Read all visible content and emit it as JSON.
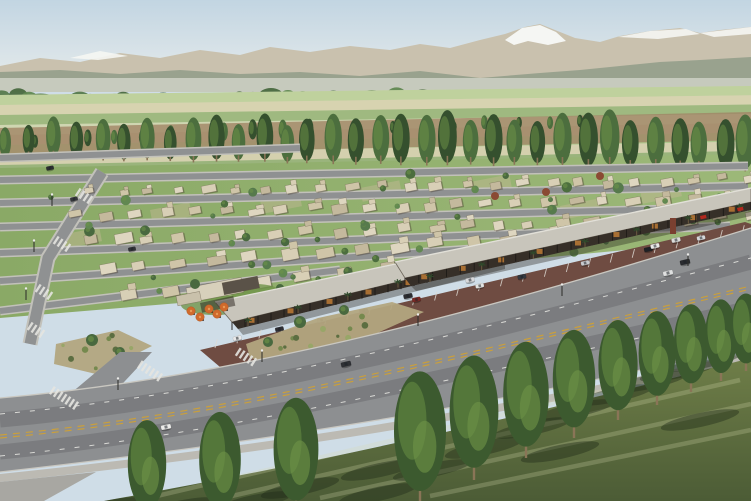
{
  "meta": {
    "title": "Aerial rendering of master-planned community",
    "description": "Aerial 3D architectural rendering of a desert master-planned community: diagonal rows of flat-roofed single-storey homes with lawns and trees, a canopied retail strip with angled parking and orange patio umbrellas, a curved boulevard lined with tall poplars in the foreground, and farmland with poplar windrows rising to snow-capped mountains under a pale hazy sky.",
    "canvas": {
      "width": 751,
      "height": 501
    }
  },
  "palette": {
    "skyTop": "#c2d5e2",
    "skyHor": "#e9edec",
    "mountain": "#c9c1ae",
    "snow": "#f5f6f3",
    "foothill": "#95a08b",
    "haze": "#d9dcd1",
    "tree1": "#567a4c",
    "tree2": "#49693f",
    "tree3": "#618851",
    "fieldBase": "#ccd4b0",
    "dirt": "#a08465",
    "poplarD": "#35502e",
    "poplarM": "#4c6e3e",
    "poplarL": "#6f9448",
    "lawn": "#8aa966",
    "lawnL": "#9cb878",
    "patch": "#c6b996",
    "street": "#8f9192",
    "sidewalk": "#c2c1ba",
    "houseFills": [
      "#d8cfb6",
      "#cfc5a8",
      "#c4b99d",
      "#ded6c0"
    ],
    "houseEdge": "rgba(90,78,60,0.55)",
    "houseShadow": "rgba(60,50,38,0.35)",
    "roofStrip": "#c8c5bb",
    "roofHi": "#e2e0d8",
    "roofEdge": "#6e675c",
    "storefront": "#362f28",
    "post": "#1d1a17",
    "glow": "#c57f36",
    "canShadow": "rgba(30,24,18,0.35)",
    "parking": "#6f4c42",
    "stripe": "rgba(222,219,212,0.85)",
    "walkway": "#c5c3bc",
    "bed": "#b2a580",
    "shrubs": [
      "#75894e",
      "#5c6e41",
      "#98a668"
    ],
    "road": "#8d8f91",
    "roadDark": "rgba(58,60,62,0.22)",
    "yellow": "#c99f3d",
    "whiteLine": "rgba(228,228,224,0.9)",
    "curb": "#c9c7c0",
    "sdw": "#bcbab3",
    "corner": "#a8a7a2",
    "grass1": "#6f7e48",
    "grass2": "#4c5c36",
    "streak": "rgba(216,221,176,0.25)",
    "shadow": "rgba(32,42,24,0.42)",
    "trunk": "#8a7557",
    "umb": "#d06a2c",
    "umbHi": "#e89a55",
    "umbRim": "#b35a24",
    "palm": "#2f4a2b",
    "palmTrunk": "#6b5a40",
    "red": "#b3281e",
    "monument": "#7a4030",
    "redTree": "#8a4a33",
    "carCols": [
      "#e8e8e8",
      "#2e2e33",
      "#b8bcc0",
      "#50555c",
      "#7a2a26",
      "#e2e3e1",
      "#34383f",
      "#c9cbcf",
      "#1f2124",
      "#d6d7d9"
    ]
  },
  "sky": {
    "h": 92
  },
  "mountains": {
    "silhouette": [
      [
        0,
        66
      ],
      [
        40,
        58
      ],
      [
        80,
        62
      ],
      [
        120,
        53
      ],
      [
        160,
        58
      ],
      [
        200,
        50
      ],
      [
        240,
        55
      ],
      [
        270,
        47
      ],
      [
        310,
        52
      ],
      [
        350,
        46
      ],
      [
        390,
        50
      ],
      [
        420,
        44
      ],
      [
        450,
        48
      ],
      [
        480,
        40
      ],
      [
        505,
        34
      ],
      [
        525,
        27
      ],
      [
        540,
        24
      ],
      [
        555,
        30
      ],
      [
        575,
        38
      ],
      [
        600,
        42
      ],
      [
        620,
        36
      ],
      [
        650,
        31
      ],
      [
        680,
        28
      ],
      [
        700,
        33
      ],
      [
        720,
        30
      ],
      [
        751,
        27
      ],
      [
        751,
        92
      ],
      [
        0,
        92
      ]
    ],
    "snow_main": [
      [
        505,
        40
      ],
      [
        522,
        28
      ],
      [
        540,
        25
      ],
      [
        556,
        32
      ],
      [
        566,
        41
      ],
      [
        548,
        45
      ],
      [
        528,
        41
      ],
      [
        514,
        45
      ]
    ],
    "snow_patches": [
      [
        [
          70,
          58
        ],
        [
          100,
          51
        ],
        [
          128,
          56
        ],
        [
          98,
          60
        ]
      ],
      [
        [
          618,
          37
        ],
        [
          650,
          31
        ],
        [
          686,
          29
        ],
        [
          700,
          34
        ],
        [
          658,
          39
        ]
      ],
      [
        [
          700,
          33
        ],
        [
          751,
          27
        ],
        [
          751,
          34
        ],
        [
          714,
          37
        ]
      ]
    ],
    "foothills": [
      [
        0,
        72
      ],
      [
        60,
        70
      ],
      [
        120,
        74
      ],
      [
        180,
        70
      ],
      [
        240,
        74
      ],
      [
        300,
        72
      ],
      [
        360,
        76
      ],
      [
        420,
        71
      ],
      [
        480,
        78
      ],
      [
        540,
        73
      ],
      [
        580,
        70
      ],
      [
        620,
        66
      ],
      [
        660,
        62
      ],
      [
        700,
        60
      ],
      [
        751,
        57
      ],
      [
        751,
        92
      ],
      [
        0,
        92
      ]
    ]
  },
  "haze": {
    "y": 78,
    "h": 14
  },
  "treeline": {
    "y": 95,
    "count": 62,
    "row2_count": 30
  },
  "farmland": {
    "top": [
      [
        0,
        95
      ],
      [
        751,
        86
      ]
    ],
    "bottom": [
      [
        0,
        175
      ],
      [
        751,
        160
      ]
    ],
    "strip_colors": [
      "#bcd09a",
      "#d8d2b0",
      "#96b478",
      "#cfd6b2",
      "#c4b795",
      "#a9c487",
      "#d5cfae",
      "#90ae73"
    ]
  },
  "dirt_band": [
    [
      0,
      128
    ],
    [
      751,
      112
    ],
    [
      751,
      140
    ],
    [
      0,
      156
    ]
  ],
  "poplar_rows": [
    {
      "x1": 5,
      "y1": 150,
      "x2": 335,
      "y2": 138,
      "count": 13,
      "h1": 14,
      "h2": 19,
      "big": false
    },
    {
      "x1": 360,
      "y1": 134,
      "x2": 580,
      "y2": 128,
      "count": 8,
      "h1": 11,
      "h2": 14,
      "big": false
    },
    {
      "x1": 8,
      "y1": 158,
      "x2": 748,
      "y2": 170,
      "count": 33,
      "h1": 34,
      "h2": 54,
      "big": true
    }
  ],
  "residential": {
    "base_quad": [
      [
        0,
        168
      ],
      [
        751,
        154
      ],
      [
        751,
        238
      ],
      [
        520,
        260
      ],
      [
        240,
        298
      ],
      [
        0,
        318
      ]
    ],
    "patches": [
      [
        60,
        235
      ],
      [
        150,
        210
      ],
      [
        260,
        200
      ],
      [
        360,
        188
      ],
      [
        470,
        182
      ],
      [
        560,
        206
      ],
      [
        640,
        190
      ]
    ],
    "streets": [
      [
        0,
        158,
        300,
        148
      ],
      [
        0,
        180,
        748,
        166
      ],
      [
        0,
        203,
        748,
        186
      ],
      [
        0,
        227,
        748,
        207
      ],
      [
        0,
        253,
        730,
        226
      ],
      [
        0,
        281,
        560,
        243
      ],
      [
        0,
        311,
        340,
        270
      ]
    ],
    "collector": [
      [
        102,
        172
      ],
      [
        48,
        258
      ],
      [
        30,
        344
      ]
    ],
    "house_rows": [
      {
        "x1": 88,
        "y1": 190,
        "x2": 744,
        "y2": 176,
        "n": 24,
        "s": 0.78
      },
      {
        "x1": 70,
        "y1": 213,
        "x2": 746,
        "y2": 194,
        "n": 24,
        "s": 0.88
      },
      {
        "x1": 80,
        "y1": 238,
        "x2": 742,
        "y2": 212,
        "n": 22,
        "s": 1
      },
      {
        "x1": 96,
        "y1": 264,
        "x2": 612,
        "y2": 228,
        "n": 15,
        "s": 1.1
      },
      {
        "x1": 120,
        "y1": 292,
        "x2": 426,
        "y2": 260,
        "n": 8,
        "s": 1.2
      }
    ],
    "scatter_quad": [
      [
        24,
        182
      ],
      [
        738,
        164
      ],
      [
        738,
        240
      ],
      [
        130,
        300
      ]
    ],
    "scatter_count": 46,
    "red_trees": [
      [
        495,
        196
      ],
      [
        546,
        192
      ],
      [
        600,
        176
      ]
    ],
    "grid_cars": [
      [
        50,
        168,
        "#2b2d30"
      ],
      [
        74,
        199,
        "#35373a"
      ],
      [
        106,
        215,
        "#e6e6e4"
      ],
      [
        132,
        249,
        "#303236"
      ]
    ]
  },
  "clubhouse": {
    "roofs": [
      [
        186,
        288,
        56,
        15,
        "#d7d0bb"
      ],
      [
        222,
        283,
        36,
        12,
        "#5a5248"
      ],
      [
        176,
        296,
        24,
        10,
        "#c9c1ab"
      ]
    ],
    "lawns": [
      [
        215,
        305,
        34,
        10
      ],
      [
        255,
        292,
        26,
        8
      ]
    ],
    "trees": [
      [
        195,
        284,
        5
      ],
      [
        246,
        300,
        4
      ],
      [
        280,
        288,
        4
      ]
    ]
  },
  "strips": [
    {
      "roof": [
        [
          215,
          302
        ],
        [
          500,
          242
        ],
        [
          505,
          256
        ],
        [
          232,
          322
        ]
      ],
      "front": [
        [
          232,
          322
        ],
        [
          505,
          256
        ],
        [
          505,
          263
        ],
        [
          238,
          329
        ]
      ],
      "shade": [
        [
          238,
          329
        ],
        [
          505,
          263
        ],
        [
          505,
          269
        ],
        [
          243,
          335
        ]
      ],
      "posts": 22,
      "glows": 7,
      "palm_line": [
        248,
        326,
        498,
        262
      ],
      "palms": 6
    },
    {
      "roof": [
        [
          395,
          262
        ],
        [
          751,
          188
        ],
        [
          751,
          202
        ],
        [
          405,
          278
        ]
      ],
      "front": [
        [
          405,
          278
        ],
        [
          751,
          202
        ],
        [
          751,
          210
        ],
        [
          411,
          286
        ]
      ],
      "shade": [
        [
          411,
          286
        ],
        [
          751,
          210
        ],
        [
          751,
          216
        ],
        [
          416,
          291
        ]
      ],
      "posts": 26,
      "glows": 9,
      "palm_line": [
        430,
        282,
        740,
        212
      ],
      "palms": 7
    }
  ],
  "pergola": {
    "x": 200,
    "y": 303,
    "w": 34,
    "h": 10
  },
  "umbrellas": [
    [
      191,
      311
    ],
    [
      200,
      317
    ],
    [
      209,
      309
    ],
    [
      217,
      314
    ],
    [
      224,
      307
    ]
  ],
  "parking": {
    "poly": [
      [
        200,
        350
      ],
      [
        745,
        222
      ],
      [
        751,
        224
      ],
      [
        751,
        256
      ],
      [
        240,
        384
      ]
    ],
    "rowA": [
      215,
      348,
      742,
      234,
      24
    ],
    "rowB": [
      245,
      380,
      748,
      260,
      22
    ],
    "carsA": [
      0.04,
      0.12,
      0.2,
      0.28,
      0.38,
      0.5,
      0.58,
      0.7,
      0.82,
      0.92
    ],
    "carsB": [
      0.08,
      0.2,
      0.36,
      0.55,
      0.72,
      0.9
    ],
    "loose": [
      [
        408,
        296,
        "#2c2c30"
      ],
      [
        470,
        280,
        "#d8d9db"
      ],
      [
        655,
        246,
        "#e8e8e6"
      ],
      [
        676,
        240,
        "#dcdcda"
      ]
    ]
  },
  "beds": [
    {
      "poly": [
        [
          246,
          344
        ],
        [
          318,
          318
        ],
        [
          392,
          302
        ],
        [
          424,
          312
        ],
        [
          362,
          340
        ],
        [
          286,
          366
        ],
        [
          250,
          358
        ]
      ],
      "shrubs": 14,
      "trees": [
        [
          300,
          322,
          6
        ],
        [
          344,
          310,
          5
        ],
        [
          268,
          342,
          5
        ]
      ]
    },
    {
      "poly": [
        [
          586,
          284
        ],
        [
          664,
          258
        ],
        [
          700,
          268
        ],
        [
          620,
          296
        ]
      ],
      "shrubs": 8,
      "trees": [
        [
          640,
          270,
          4
        ]
      ]
    },
    {
      "poly": [
        [
          56,
          344
        ],
        [
          118,
          330
        ],
        [
          152,
          346
        ],
        [
          96,
          374
        ],
        [
          54,
          364
        ]
      ],
      "shrubs": 8,
      "trees": [
        [
          92,
          340,
          6
        ],
        [
          120,
          352,
          5
        ]
      ]
    }
  ],
  "walk": [
    [
      240,
      384
    ],
    [
      751,
      256
    ],
    [
      751,
      264
    ],
    [
      247,
      392
    ]
  ],
  "monument": {
    "x": 670,
    "y": 218,
    "w": 6,
    "h": 16
  },
  "signs": [
    [
      737,
      208
    ],
    [
      700,
      216
    ]
  ],
  "boulevard": {
    "main": "M0,398 C250,376 500,306 751,228 L751,345 C500,405 250,444 0,472 Z",
    "far_curb": "M0,398 C250,376 500,306 751,228",
    "near_curb": "M751,345 C500,405 250,444 0,472",
    "side_roads": [
      [
        [
          250,
          390
        ],
        [
          332,
          344
        ],
        [
          372,
          344
        ],
        [
          298,
          396
        ]
      ],
      [
        [
          58,
          404
        ],
        [
          120,
          352
        ],
        [
          152,
          352
        ],
        [
          98,
          410
        ]
      ]
    ],
    "wear": [
      "M0,420 C250,398 500,330 751,262",
      "M0,452 C250,428 500,362 751,308"
    ],
    "yellow": [
      "M0,435 C250,412 500,344 751,286",
      "M0,438 C250,415 500,347 751,289"
    ],
    "white": [
      "M0,414 C250,392 500,324 751,258",
      "M0,456 C250,432 500,366 751,314"
    ],
    "cars": [
      [
        166,
        427,
        "#ececea",
        -11
      ],
      [
        346,
        364,
        "#2e3034",
        -13
      ],
      [
        685,
        262,
        "#2a2c30",
        -13
      ],
      [
        668,
        273,
        "#dfe0e0",
        -13
      ]
    ]
  },
  "crosswalks": [
    [
      64,
      398,
      7
    ],
    [
      150,
      371,
      6
    ],
    [
      246,
      357,
      5
    ],
    [
      84,
      196,
      4
    ],
    [
      62,
      244,
      4
    ],
    [
      44,
      292,
      4
    ],
    [
      36,
      330,
      4
    ]
  ],
  "sidewalk_near": "M0,474 C250,448 500,410 751,352 L751,360 C500,418 250,456 0,482 Z",
  "corner": [
    [
      0,
      482
    ],
    [
      96,
      472
    ],
    [
      44,
      501
    ],
    [
      0,
      501
    ]
  ],
  "grass": {
    "path": "M104,501 C300,466 520,418 751,358 L751,501 Z",
    "streaks": [
      "M140,500 L700,368",
      "M210,501 L740,380",
      "M320,498 L751,404",
      "M430,496 L751,430"
    ]
  },
  "fg_trees": [
    [
      147,
      518,
      96
    ],
    [
      220,
      518,
      104
    ],
    [
      296,
      512,
      112
    ],
    [
      420,
      504,
      130
    ],
    [
      474,
      480,
      122
    ],
    [
      526,
      458,
      114
    ],
    [
      574,
      438,
      106
    ],
    [
      618,
      420,
      98
    ],
    [
      657,
      405,
      92
    ],
    [
      691,
      392,
      86
    ],
    [
      721,
      381,
      80
    ],
    [
      746,
      371,
      76
    ]
  ],
  "extra_shadows": [
    [
      380,
      470
    ],
    [
      300,
      488
    ],
    [
      560,
      452
    ],
    [
      700,
      420
    ]
  ],
  "streetlights": [
    [
      118,
      390
    ],
    [
      262,
      362
    ],
    [
      418,
      326
    ],
    [
      562,
      296
    ],
    [
      688,
      266
    ],
    [
      34,
      252
    ],
    [
      52,
      206
    ],
    [
      26,
      300
    ]
  ]
}
